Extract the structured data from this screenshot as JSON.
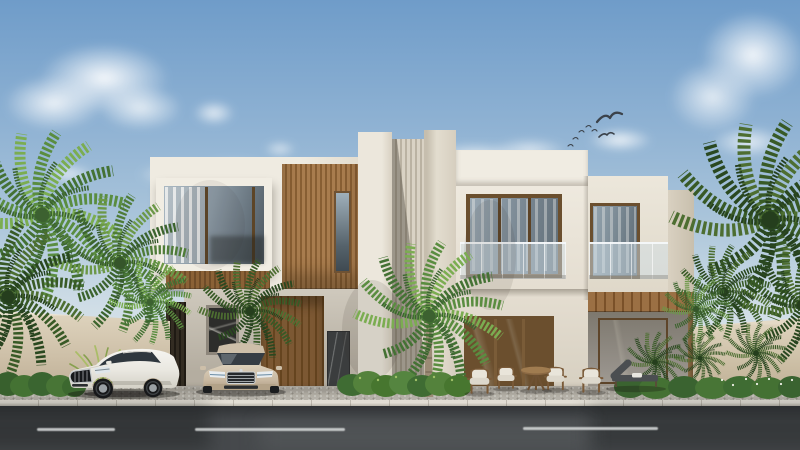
{
  "scene": {
    "type": "architectural-exterior-rendering",
    "time_of_day": "day",
    "description": "Street-front daytime rendering of a modern two-storey luxury villa in white marble with warm wood slat accents, fluted stone tower, bronze-framed glazing and frosted glass balconies; date palms and hedges line a beige boundary wall; two luxury sedans are parked on the forecourt beside an asphalt road with dashed lane markings; gulls fly overhead.",
    "sky": {
      "clouds": 9,
      "birds": 7
    },
    "villa": {
      "storeys": 2,
      "materials": [
        "white marble",
        "fluted travertine",
        "wood slats",
        "bronze-framed glass",
        "frosted glass balustrades"
      ],
      "features": [
        "floating picture-window box",
        "fluted marble tower",
        "two glass balconies",
        "wood pergola porch",
        "slatted garage door",
        "dark marble entry panel",
        "abstract art window"
      ]
    },
    "vehicles": [
      {
        "name": "white-luxury-sedan",
        "view": "three-quarter front",
        "color_hex": "#e9e7e0"
      },
      {
        "name": "champagne-luxury-sedan",
        "view": "front",
        "color_hex": "#c9b9a2"
      }
    ],
    "furniture": [
      "four wood armchairs with white cushions",
      "round wood side table",
      "grey sun lounger"
    ],
    "landscaping": [
      "date palm clusters left",
      "single palm at centre",
      "dense palm group right",
      "boxwood hedges",
      "fountain grass",
      "white-flowering shrubs"
    ],
    "street": {
      "surface": "asphalt",
      "lane_dashes": 3,
      "curb": "light concrete",
      "sidewalk": "speckled concrete"
    }
  },
  "palette": {
    "sky-top": "#6f9cc9",
    "sky-mid": "#a9c4da",
    "sky-low": "#cfdde6",
    "sky-horizon": "#e4eaec",
    "marble-light": "#efebe1",
    "marble": "#e6e1d4",
    "marble-shade": "#cfc8ba",
    "wood": "#a87c4e",
    "wood-dark": "#875e33",
    "frame-bronze": "#6b4f2e",
    "wall-beige": "#d6cab4",
    "wall-beige-dark": "#bdae95",
    "pave": "#b5b1a8",
    "curb": "#e2ded4",
    "road": "#46494c",
    "lane": "#d8dbdb",
    "green-1": "#6c9847",
    "green-2": "#4f7c38",
    "green-3": "#3c642e",
    "trunk": "#9b8b75",
    "bird": "#3b424a",
    "car-white": "#e9e7e0",
    "car-champagne": "#c9b9a2",
    "cushion": "#e9e5da",
    "furn-wood": "#7a5a38",
    "art-bg": "#2d2d2b",
    "panel-dark": "#3b3d3e"
  }
}
